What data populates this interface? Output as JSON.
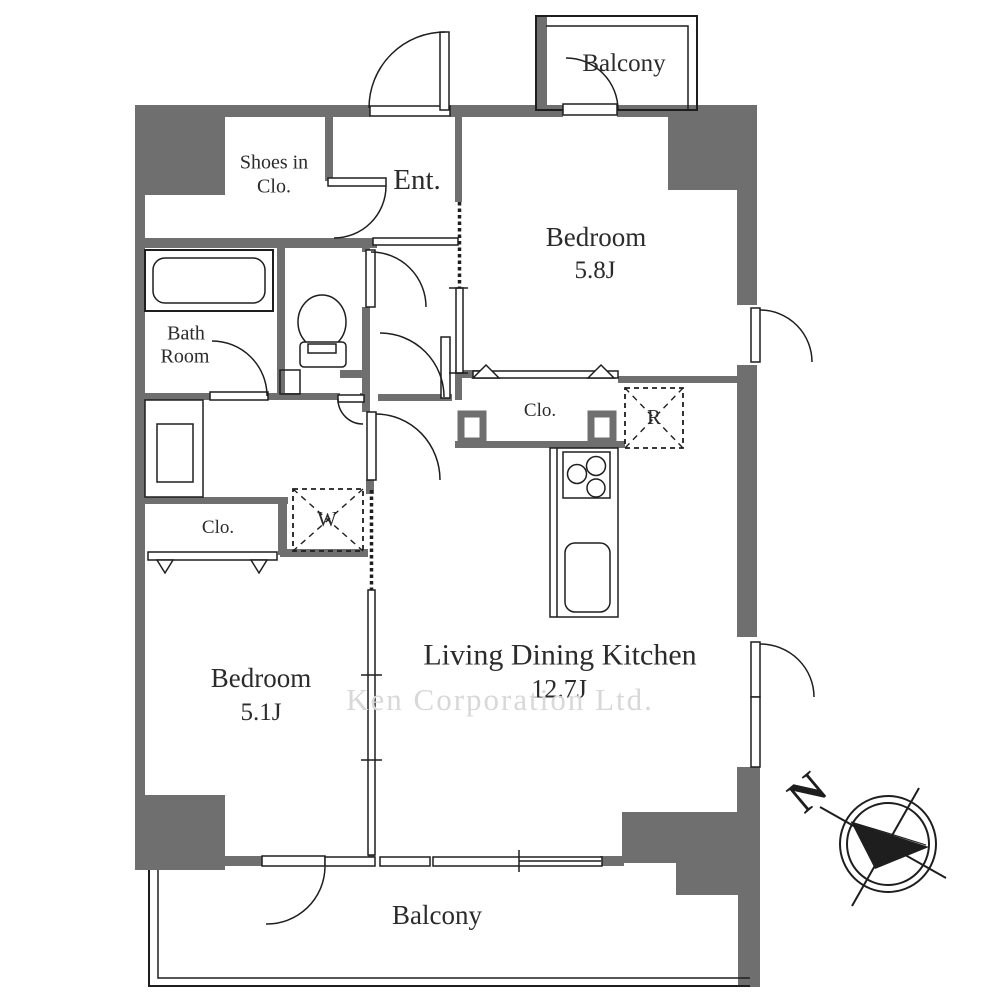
{
  "colors": {
    "wall": "#6f6f6f",
    "line": "#1e1e1e",
    "text": "#2b2b2b",
    "watermark": "#d8d8d8",
    "bg": "#ffffff"
  },
  "labels": {
    "balcony_top": "Balcony",
    "shoes_closet_line1": "Shoes in",
    "shoes_closet_line2": "Clo.",
    "entrance": "Ent.",
    "bedroom1_name": "Bedroom",
    "bedroom1_size": "5.8J",
    "bath_line1": "Bath",
    "bath_line2": "Room",
    "closet_upper": "Clo.",
    "refrigerator": "R",
    "washing_machine": "W",
    "closet_lower": "Clo.",
    "bedroom2_name": "Bedroom",
    "bedroom2_size": "5.1J",
    "ldk_name": "Living Dining Kitchen",
    "ldk_size": "12.7J",
    "balcony_bottom": "Balcony",
    "compass_north": "N",
    "watermark": "Ken Corporation Ltd."
  }
}
